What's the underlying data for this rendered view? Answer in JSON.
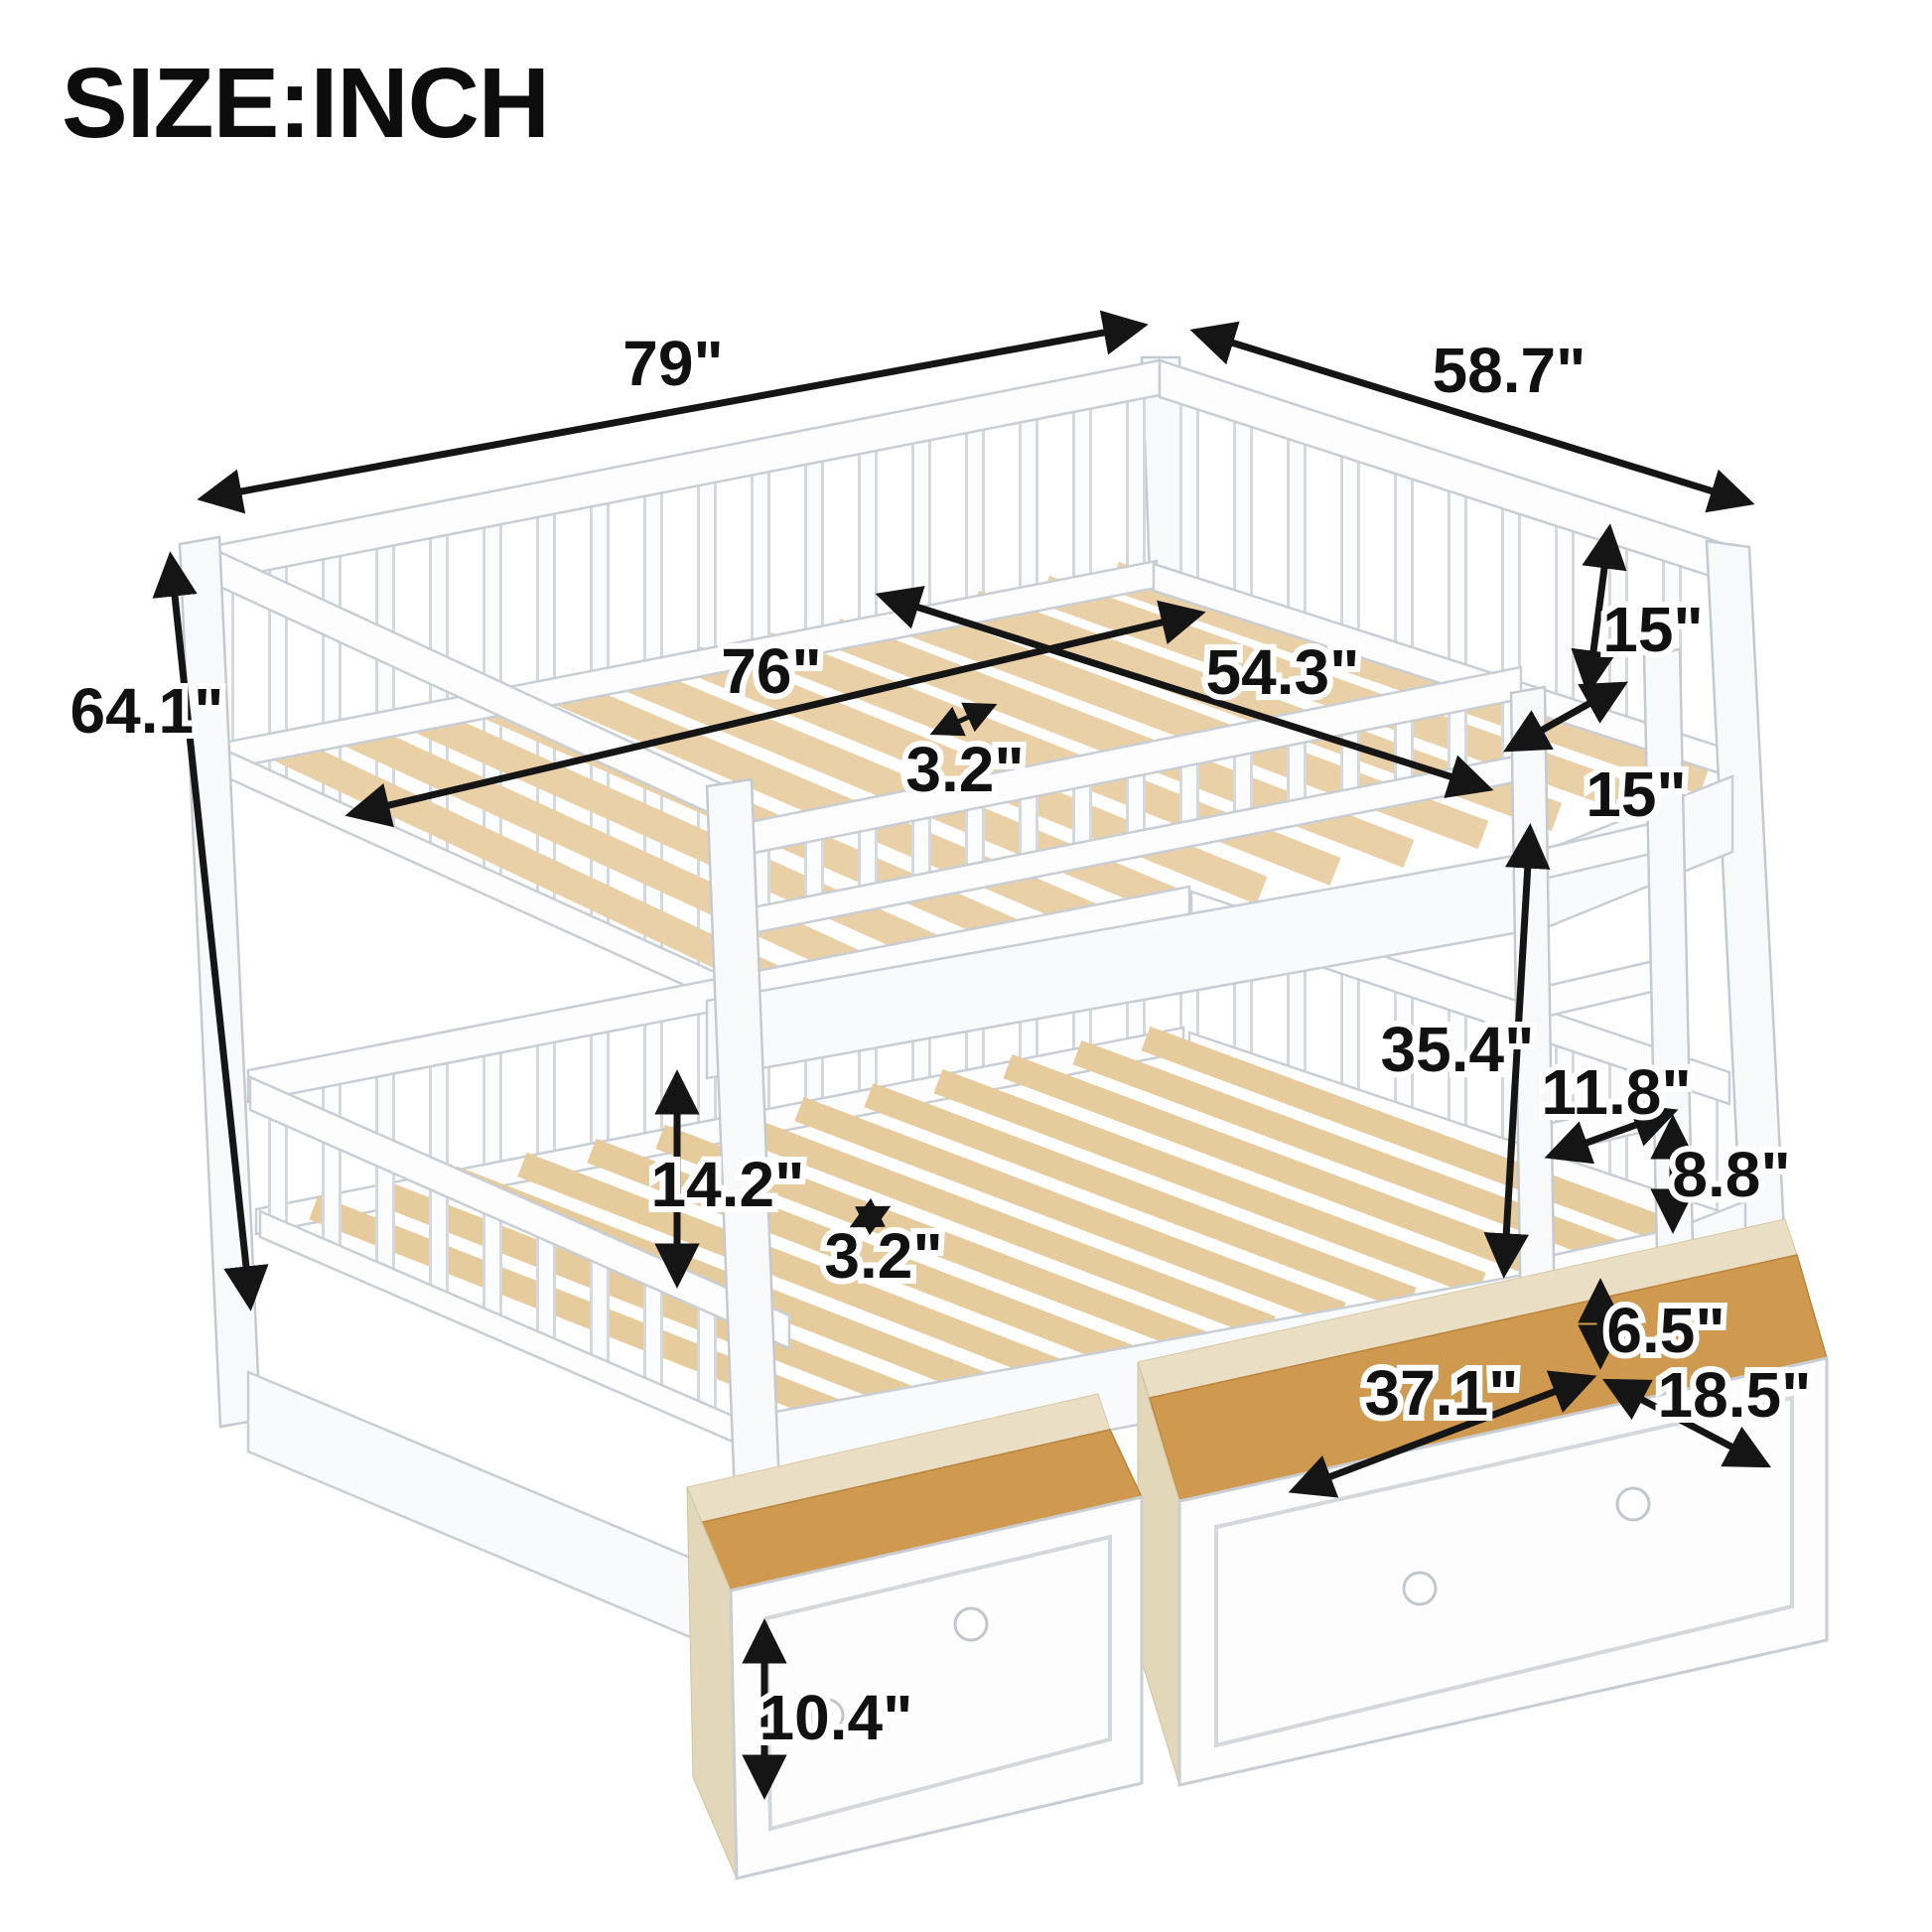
{
  "title": "SIZE:INCH",
  "unit": "INCH",
  "palette": {
    "background": "#ffffff",
    "annotation_black": "#151515",
    "label_halo": "#ffffff",
    "wood_white": "#fdfdfe",
    "wood_outline": "#c9ced4",
    "slat_wood": "#e9d0a6",
    "drawer_floor_wood": "#cf9950",
    "drawer_wall_wood": "#eadfc4"
  },
  "dimensions": {
    "overall_length": "79\"",
    "overall_width": "58.7\"",
    "mattress_length": "76\"",
    "mattress_width": "54.3\"",
    "upper_slat_gap": "3.2\"",
    "guardrail_height_back": "15\"",
    "guardrail_height_side": "15\"",
    "overall_height": "64.1\"",
    "bunk_clearance": "35.4\"",
    "ladder_rung_width": "11.8\"",
    "ladder_rung_spacing": "8.8\"",
    "lower_clearance": "14.2\"",
    "lower_slat_gap": "3.2\"",
    "drawer_clearance": "6.5\"",
    "drawer_length": "37.1\"",
    "drawer_depth": "18.5\"",
    "drawer_height": "10.4\""
  }
}
